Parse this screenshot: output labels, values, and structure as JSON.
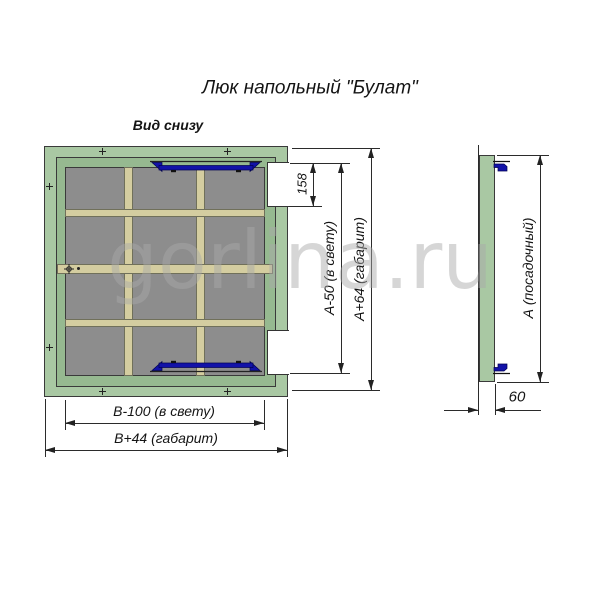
{
  "title": "Люк напольный \"Булат\"",
  "view_label": "Вид снизу",
  "watermark": "gorlina.ru",
  "colors": {
    "frame_green": "#a9c8a3",
    "rail_green": "#96b990",
    "panel_gray": "#8d8d8d",
    "bar_tan": "#d4cda0",
    "latch_blue": "#1212a8",
    "line_color": "#2b2b2b"
  },
  "bottom_view": {
    "dims": {
      "hinge_offset": "158",
      "height_clear": "А-50 (в свету)",
      "height_overall": "А+64 (габарит)",
      "width_clear": "В-100 (в свету)",
      "width_overall": "В+44 (габарит)"
    }
  },
  "side_view": {
    "dims": {
      "seat_height": "А (посадочный)",
      "depth": "60"
    }
  }
}
